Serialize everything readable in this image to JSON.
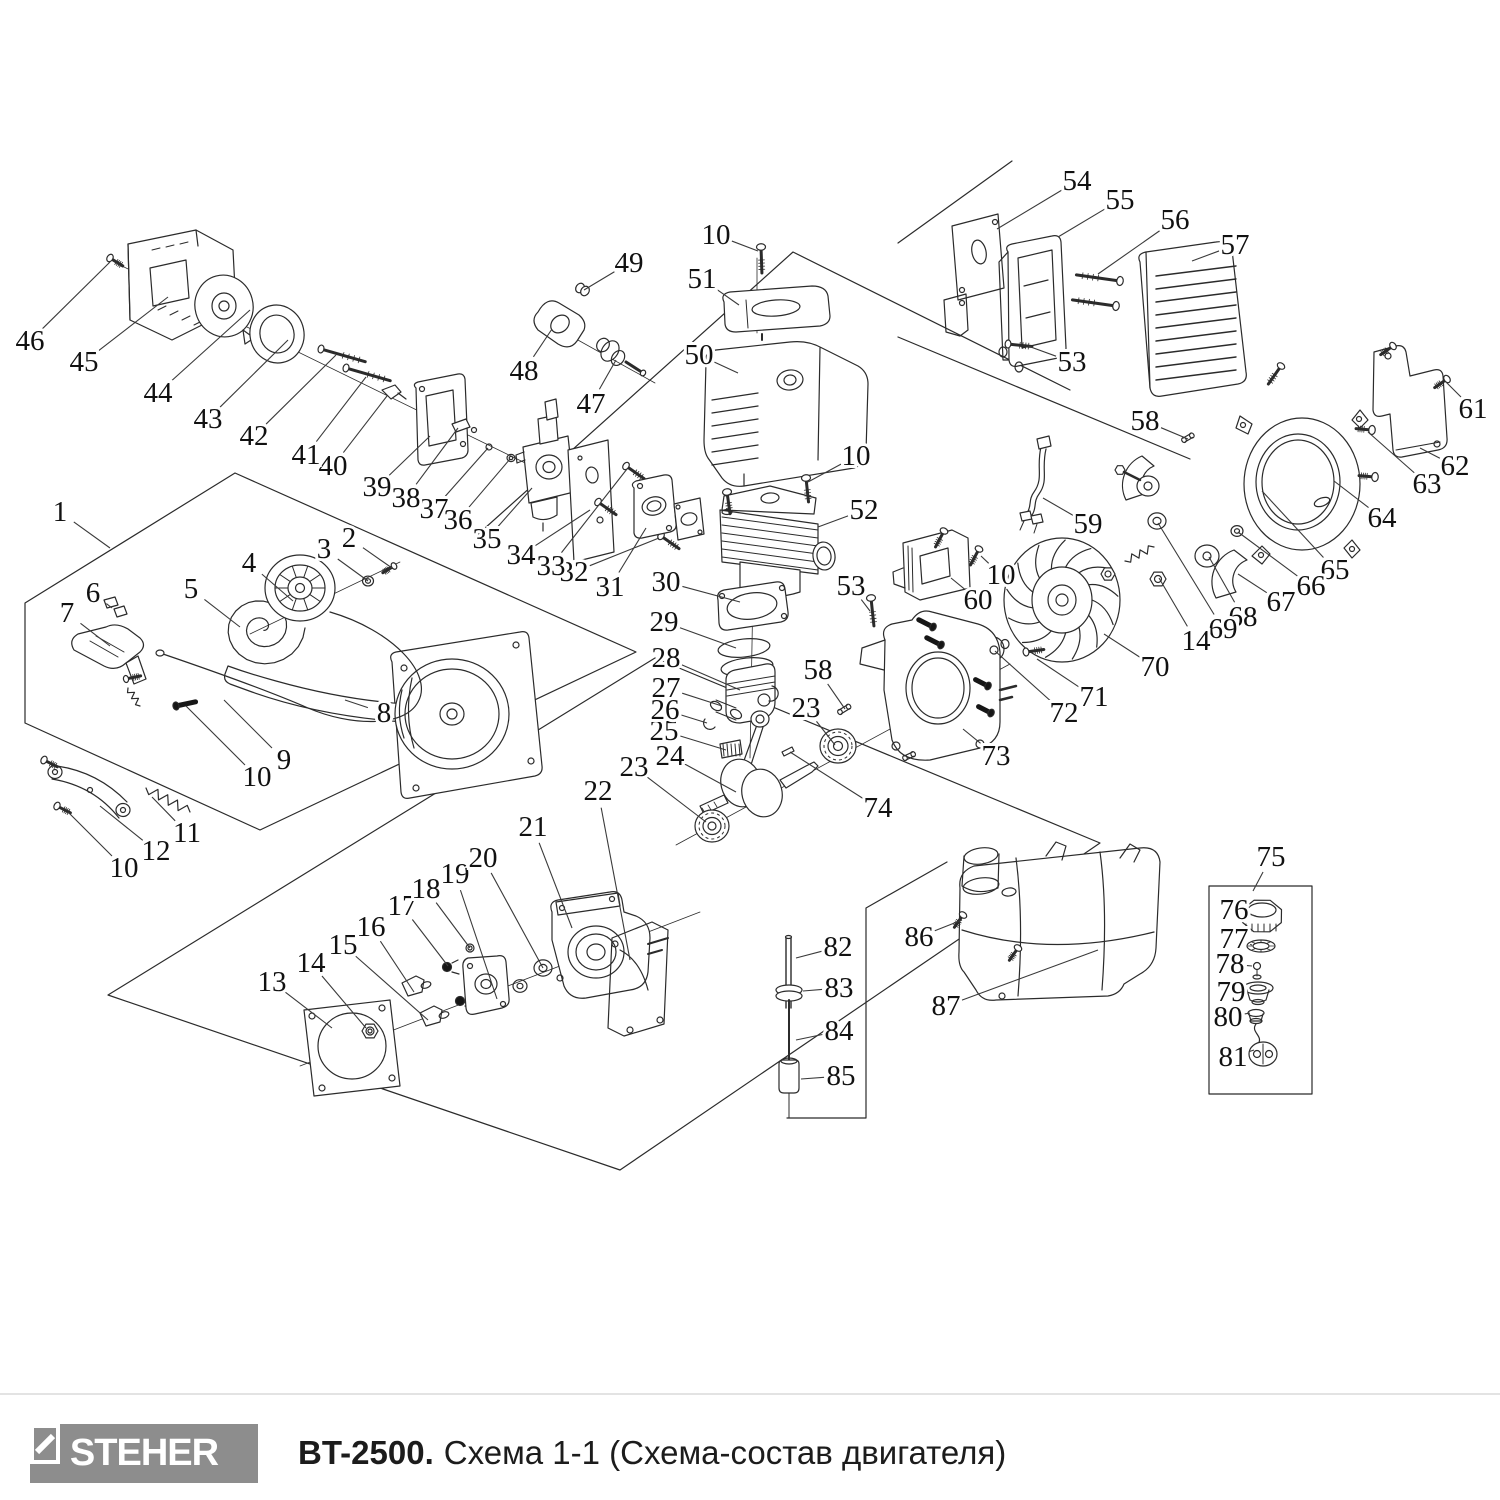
{
  "footer": {
    "brand": "STEHER",
    "model": "BT-2500.",
    "subtitle": "Схема 1-1 (Схема-состав двигателя)"
  },
  "diagram": {
    "colors": {
      "line": "#2b2b2b",
      "label": "#111111",
      "leader": "#3a3a3a",
      "logo_bg": "#8d8d8d",
      "divider": "#e3e3e3",
      "title": "#1c1c1c"
    },
    "callouts": [
      [
        "1",
        60,
        512,
        110,
        548
      ],
      [
        "2",
        349,
        538,
        392,
        568
      ],
      [
        "3",
        324,
        549,
        368,
        581
      ],
      [
        "4",
        249,
        563,
        293,
        601
      ],
      [
        "5",
        191,
        589,
        240,
        627
      ],
      [
        "6",
        93,
        593,
        112,
        608
      ],
      [
        "7",
        67,
        613,
        110,
        646
      ],
      [
        "8",
        384,
        713,
        345,
        700
      ],
      [
        "9",
        284,
        760,
        224,
        700
      ],
      [
        "10",
        257,
        777,
        186,
        706
      ],
      [
        "11",
        187,
        833,
        152,
        797
      ],
      [
        "12",
        156,
        851,
        100,
        806
      ],
      [
        "10",
        124,
        868,
        68,
        812
      ],
      [
        "13",
        272,
        982,
        332,
        1028
      ],
      [
        "14",
        311,
        963,
        366,
        1028
      ],
      [
        "15",
        343,
        945,
        428,
        1020
      ],
      [
        "16",
        371,
        927,
        414,
        992
      ],
      [
        "17",
        402,
        906,
        448,
        966
      ],
      [
        "18",
        426,
        889,
        470,
        948
      ],
      [
        "19",
        455,
        874,
        497,
        999
      ],
      [
        "20",
        483,
        858,
        543,
        968
      ],
      [
        "21",
        533,
        827,
        572,
        928
      ],
      [
        "22",
        598,
        791,
        630,
        960
      ],
      [
        "23",
        634,
        767,
        706,
        822
      ],
      [
        "24",
        670,
        756,
        736,
        792
      ],
      [
        "25",
        664,
        731,
        726,
        750
      ],
      [
        "26",
        665,
        710,
        707,
        723
      ],
      [
        "27",
        666,
        688,
        722,
        706
      ],
      [
        "28",
        666,
        658,
        740,
        690
      ],
      [
        "29",
        664,
        622,
        736,
        648
      ],
      [
        "30",
        666,
        582,
        740,
        602
      ],
      [
        "31",
        610,
        587,
        646,
        528
      ],
      [
        "32",
        574,
        572,
        659,
        538
      ],
      [
        "33",
        551,
        566,
        627,
        469
      ],
      [
        "34",
        521,
        555,
        590,
        510
      ],
      [
        "35",
        487,
        539,
        532,
        488
      ],
      [
        "36",
        458,
        520,
        510,
        459
      ],
      [
        "37",
        434,
        509,
        488,
        448
      ],
      [
        "38",
        406,
        498,
        458,
        428
      ],
      [
        "39",
        377,
        487,
        430,
        436
      ],
      [
        "40",
        333,
        466,
        387,
        396
      ],
      [
        "41",
        306,
        455,
        366,
        377
      ],
      [
        "42",
        254,
        436,
        336,
        355
      ],
      [
        "43",
        208,
        419,
        288,
        340
      ],
      [
        "44",
        158,
        393,
        250,
        310
      ],
      [
        "45",
        84,
        362,
        168,
        297
      ],
      [
        "46",
        30,
        341,
        110,
        262
      ],
      [
        "47",
        591,
        404,
        616,
        360
      ],
      [
        "48",
        524,
        371,
        552,
        329
      ],
      [
        "49",
        629,
        263,
        584,
        290
      ],
      [
        "50",
        699,
        355,
        738,
        373
      ],
      [
        "51",
        702,
        279,
        739,
        305
      ],
      [
        "10",
        716,
        235,
        758,
        251
      ],
      [
        "10",
        856,
        456,
        808,
        482
      ],
      [
        "52",
        864,
        510,
        818,
        527
      ],
      [
        "53",
        1072,
        362,
        1028,
        346
      ],
      [
        "54",
        1077,
        181,
        997,
        229
      ],
      [
        "55",
        1120,
        200,
        1058,
        237
      ],
      [
        "56",
        1175,
        220,
        1098,
        274
      ],
      [
        "57",
        1235,
        245,
        1192,
        261
      ],
      [
        "58",
        1145,
        421,
        1188,
        439
      ],
      [
        "59",
        1088,
        524,
        1043,
        498
      ],
      [
        "10",
        1001,
        575,
        981,
        556
      ],
      [
        "60",
        978,
        600,
        951,
        578
      ],
      [
        "61",
        1473,
        409,
        1446,
        382
      ],
      [
        "62",
        1455,
        466,
        1420,
        448
      ],
      [
        "63",
        1427,
        484,
        1368,
        432
      ],
      [
        "64",
        1382,
        518,
        1334,
        481
      ],
      [
        "65",
        1335,
        570,
        1262,
        491
      ],
      [
        "66",
        1311,
        586,
        1238,
        532
      ],
      [
        "67",
        1281,
        602,
        1238,
        574
      ],
      [
        "68",
        1243,
        617,
        1209,
        557
      ],
      [
        "69",
        1223,
        629,
        1158,
        523
      ],
      [
        "14",
        1196,
        641,
        1159,
        578
      ],
      [
        "70",
        1155,
        667,
        1104,
        634
      ],
      [
        "71",
        1094,
        697,
        1037,
        659
      ],
      [
        "72",
        1064,
        713,
        995,
        651
      ],
      [
        "73",
        996,
        756,
        963,
        729
      ],
      [
        "53",
        851,
        586,
        870,
        611
      ],
      [
        "58",
        818,
        670,
        845,
        709
      ],
      [
        "23",
        806,
        708,
        835,
        745
      ],
      [
        "74",
        878,
        808,
        790,
        752
      ],
      [
        "82",
        838,
        947,
        796,
        958
      ],
      [
        "83",
        839,
        988,
        803,
        991
      ],
      [
        "84",
        839,
        1031,
        796,
        1040
      ],
      [
        "85",
        841,
        1076,
        801,
        1079
      ],
      [
        "86",
        919,
        937,
        962,
        920
      ],
      [
        "87",
        946,
        1006,
        1098,
        950
      ],
      [
        "75",
        1271,
        857,
        1253,
        891
      ],
      [
        "76",
        1234,
        910,
        1256,
        916
      ],
      [
        "77",
        1234,
        939,
        1252,
        945
      ],
      [
        "78",
        1230,
        964,
        1252,
        966
      ],
      [
        "79",
        1231,
        992,
        1248,
        990
      ],
      [
        "80",
        1228,
        1017,
        1250,
        1013
      ],
      [
        "81",
        1233,
        1057,
        1254,
        1050
      ]
    ]
  }
}
